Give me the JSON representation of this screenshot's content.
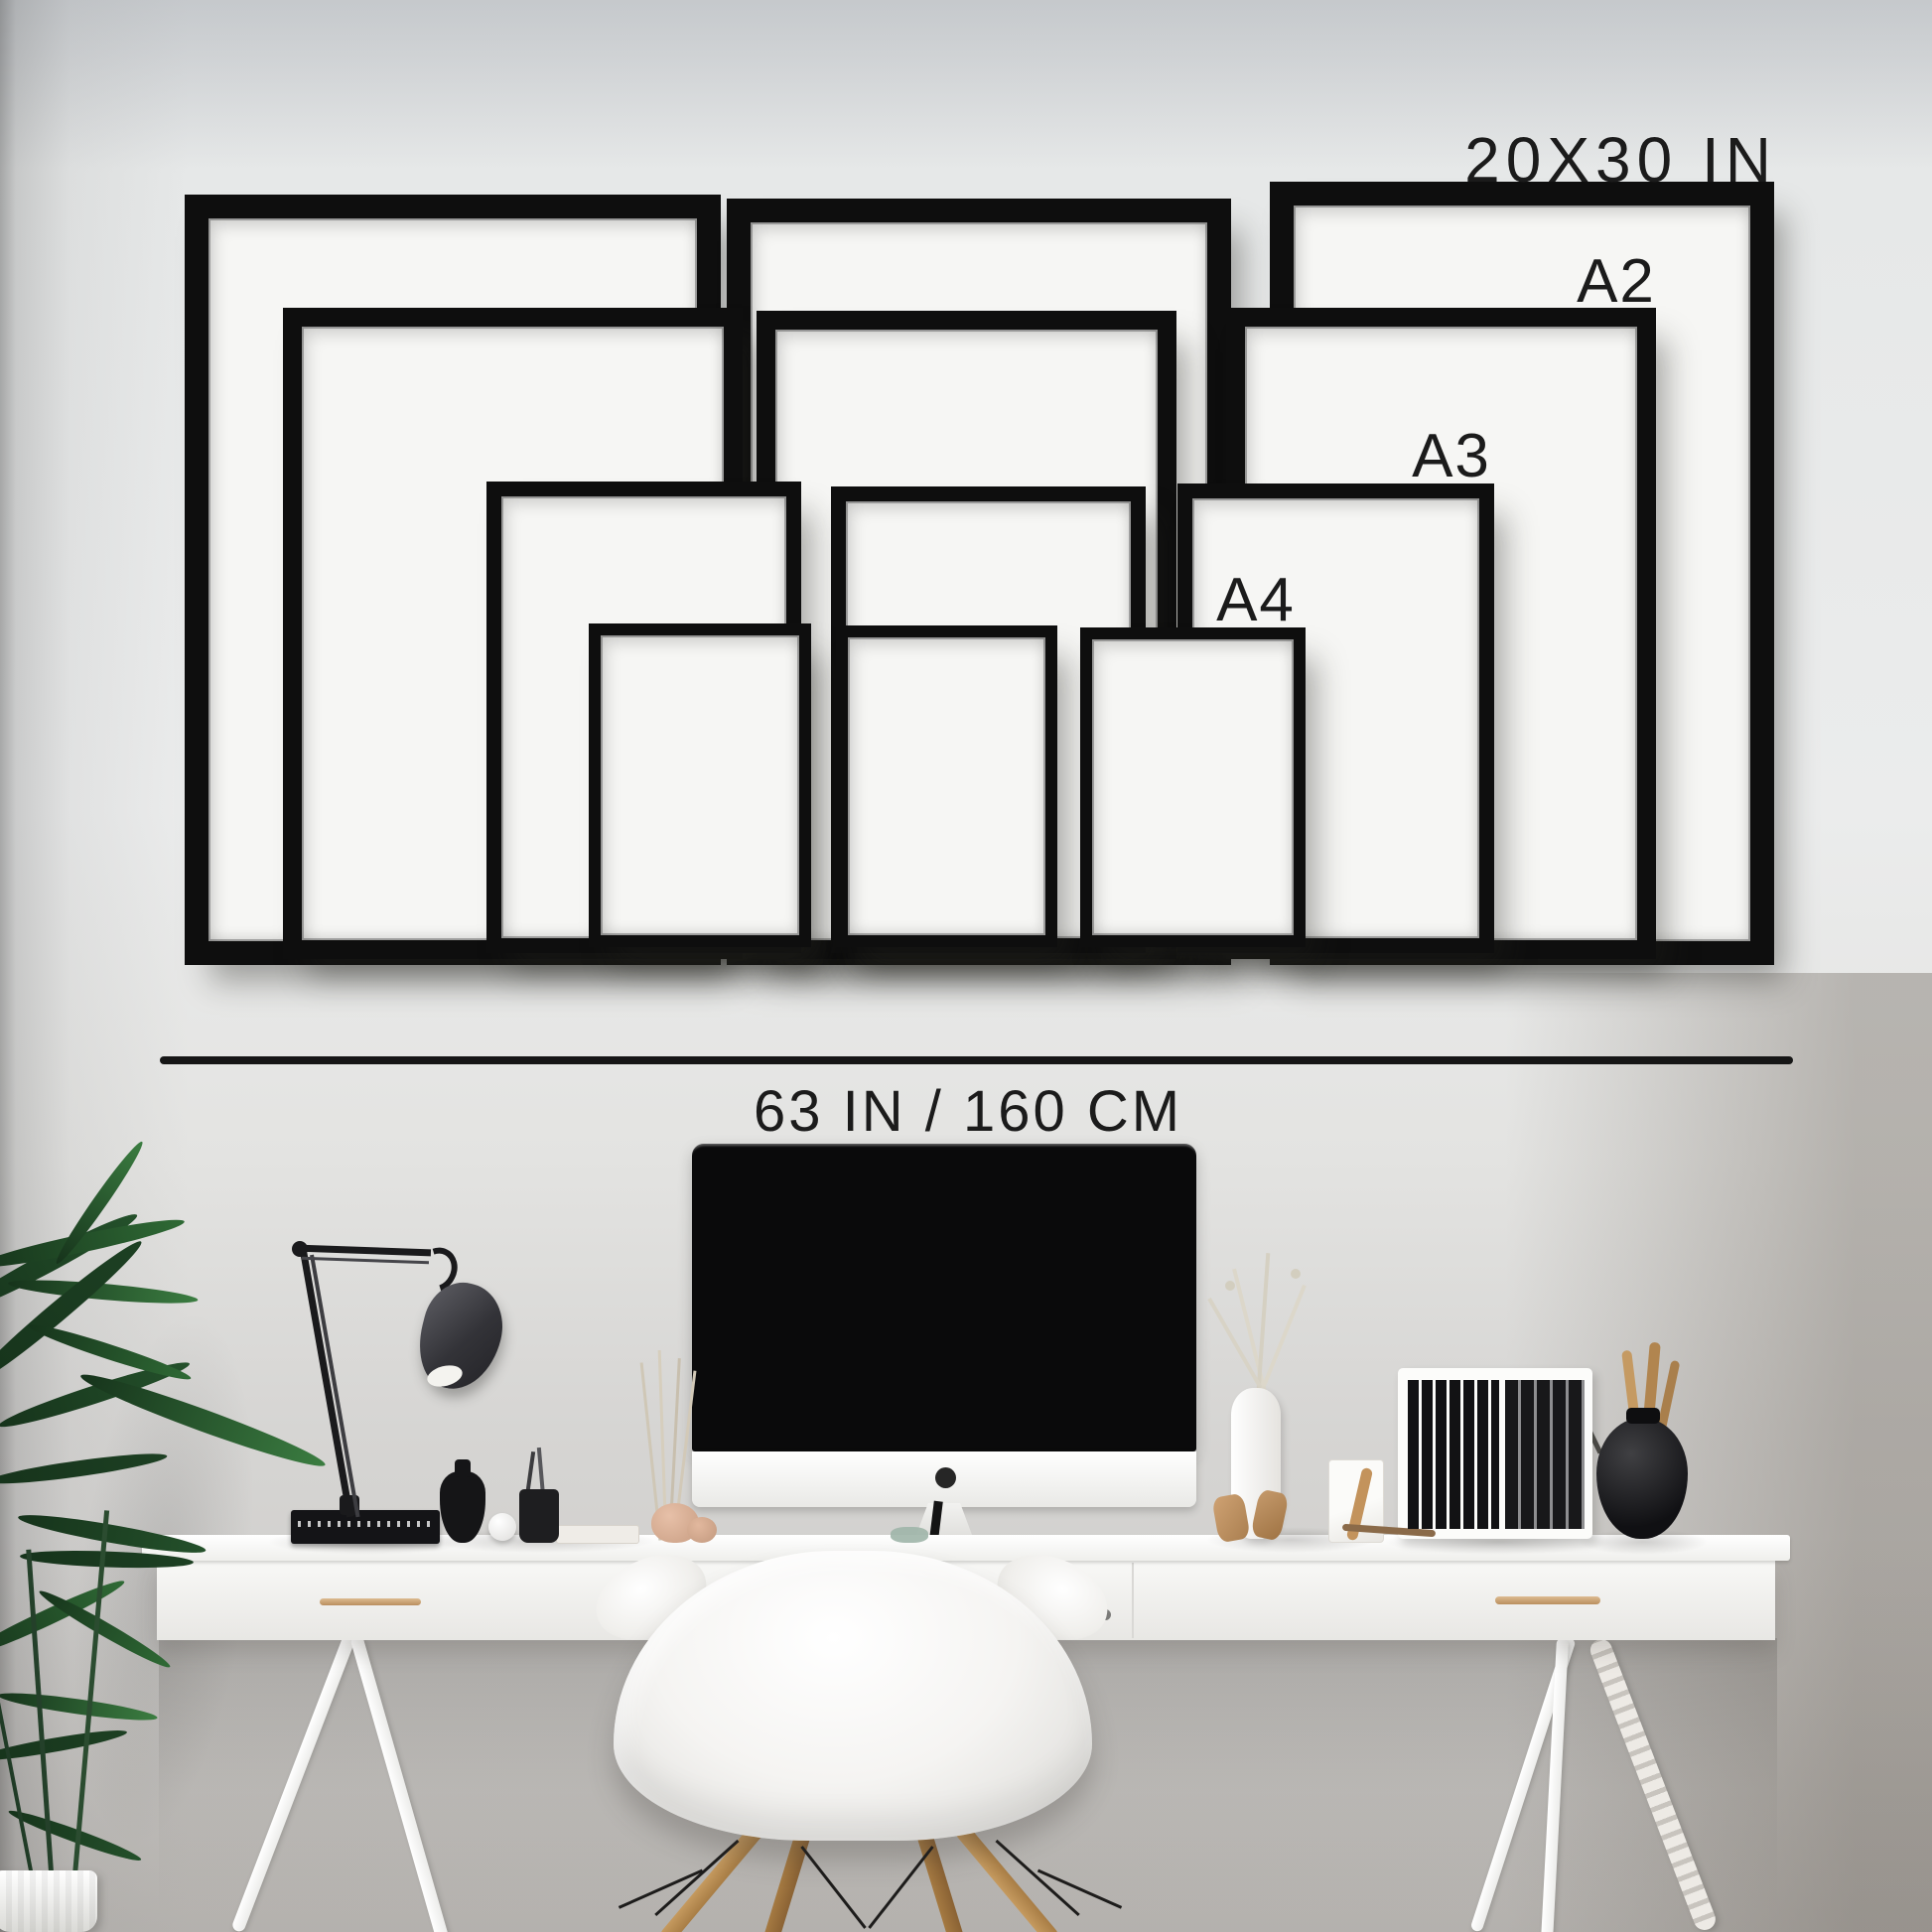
{
  "size_guide": {
    "sizes": [
      {
        "id": "20x30",
        "label": "20X30 IN",
        "frames_shown": 3
      },
      {
        "id": "a2",
        "label": "A2",
        "frames_shown": 3
      },
      {
        "id": "a3",
        "label": "A3",
        "frames_shown": 3
      },
      {
        "id": "a4",
        "label": "A4",
        "frames_shown": 3
      }
    ],
    "wall_width_caption": "63 IN / 160 CM",
    "colors": {
      "frame": "#0e0e0e",
      "mat": "#f6f6f4",
      "label_text": "#1b1b1b",
      "divider": "#161616",
      "wall": "#e9eaea",
      "desk": "#f7f7f5",
      "wood_accent": "#bf9054",
      "plant_green": "#2f6a35"
    }
  },
  "scene": {
    "objects": [
      "potted-palm-plant",
      "black-desk-lamp",
      "book-stack",
      "black-bud-vase",
      "white-sphere",
      "pen-cup",
      "dried-grass-stems",
      "pink-stones",
      "desktop-monitor",
      "green-glass-dish",
      "white-branch-vase",
      "marble-box-with-figurine",
      "wooden-stick",
      "magazine-file-with-black-folders",
      "black-round-vase-with-brushes",
      "white-desk-with-drawers",
      "brass-drawer-handle",
      "white-shell-chair-wooden-legs"
    ]
  }
}
